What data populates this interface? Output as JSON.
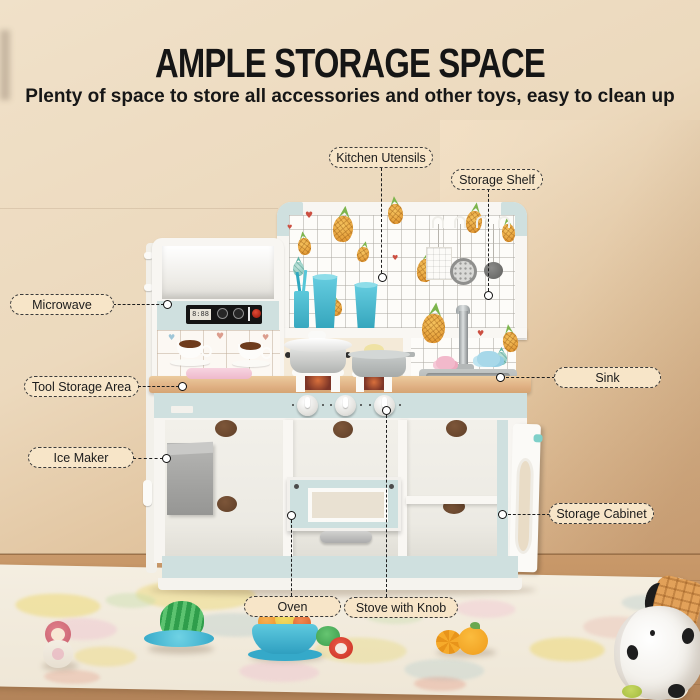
{
  "header": {
    "title": "AMPLE STORAGE SPACE",
    "subtitle": "Plenty of space to store all accessories and other toys, easy to clean up"
  },
  "callouts": [
    {
      "id": "kitchen-utensils",
      "text": "Kitchen Utensils"
    },
    {
      "id": "storage-shelf",
      "text": "Storage Shelf"
    },
    {
      "id": "microwave",
      "text": "Microwave"
    },
    {
      "id": "tool-storage-area",
      "text": "Tool Storage Area"
    },
    {
      "id": "ice-maker",
      "text": "Ice Maker"
    },
    {
      "id": "sink",
      "text": "Sink"
    },
    {
      "id": "storage-cabinet",
      "text": "Storage Cabinet"
    },
    {
      "id": "oven",
      "text": "Oven"
    },
    {
      "id": "stove-with-knob",
      "text": "Stove with Knob"
    }
  ],
  "kitchen": {
    "microwave_display": "8:88"
  },
  "icons": {
    "heart": "♥"
  },
  "colors": {
    "wall": "#ecd9bd",
    "accent_mint": "#cfe0df",
    "counter_wood": "#e2b583",
    "floor_wood": "#c0915f",
    "label_fill": "#f7e5c8",
    "leader_line": "#1e1e1e",
    "toy_teal": "#41b8d5"
  }
}
